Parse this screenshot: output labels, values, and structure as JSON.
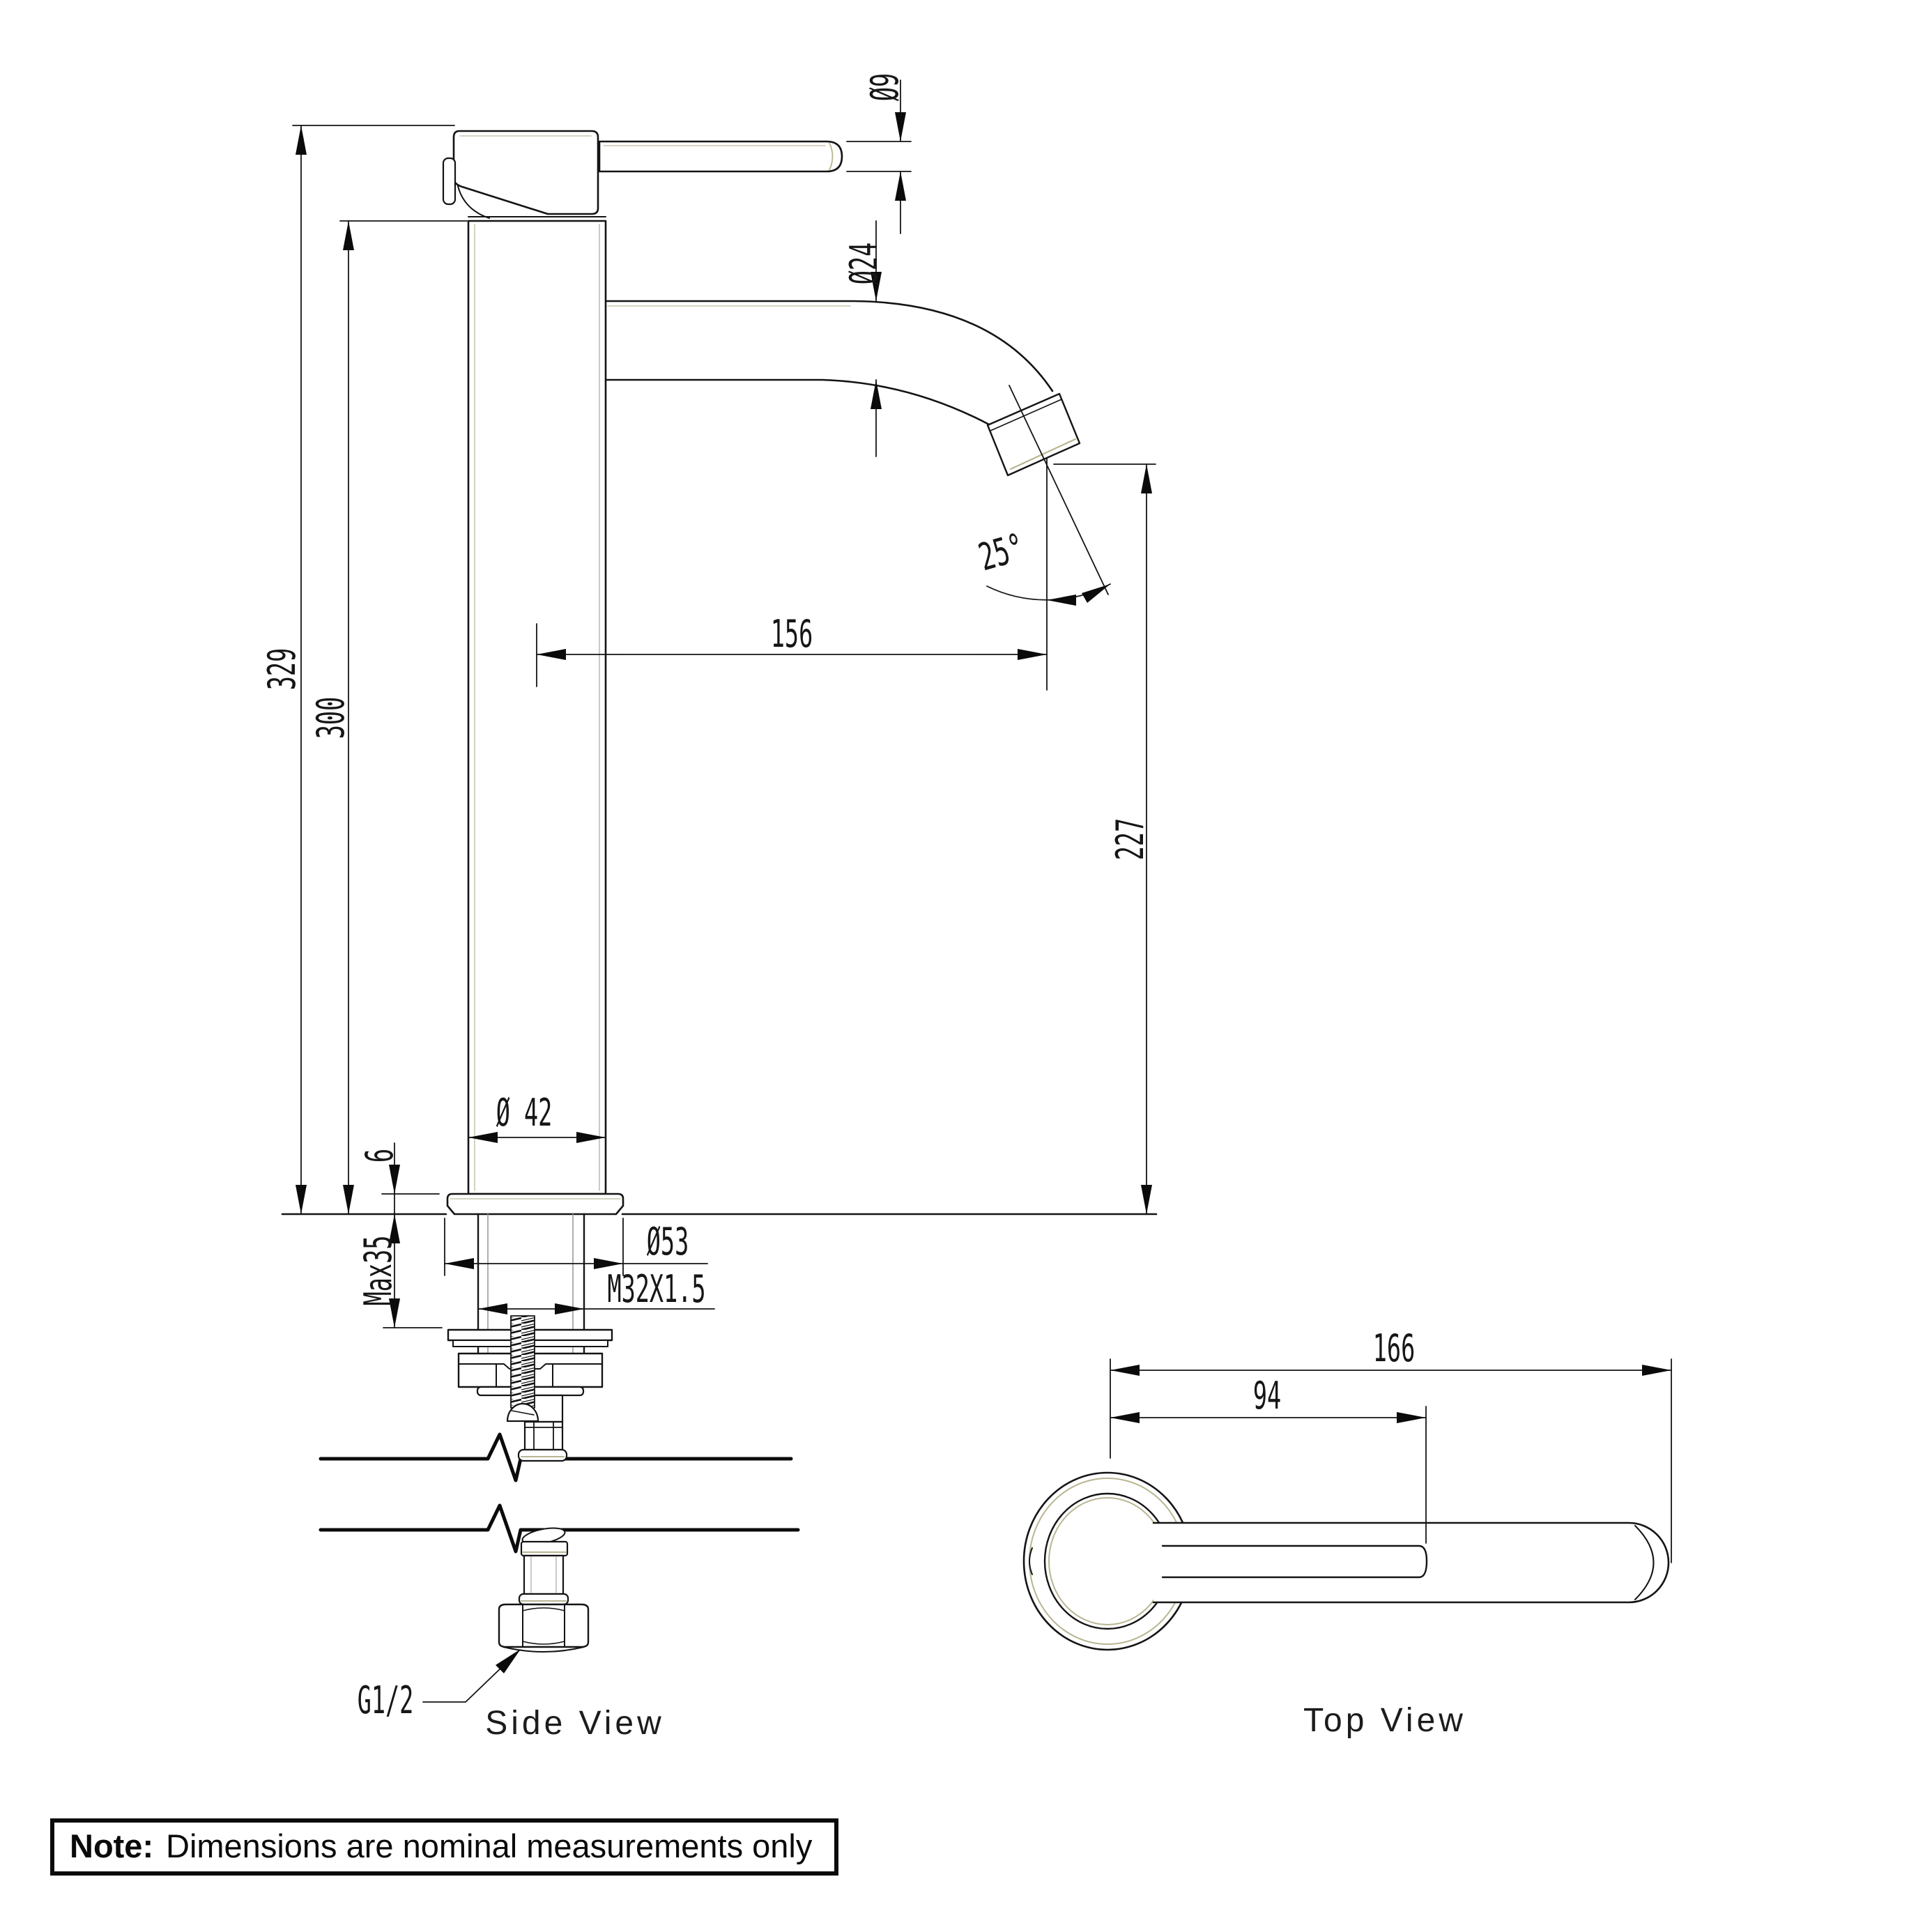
{
  "drawing": {
    "title_note": {
      "label": "Note:",
      "text": "Dimensions are nominal measurements only"
    },
    "captions": {
      "side_view": "Side View",
      "top_view": "Top View"
    },
    "side_view_dims": {
      "overall_height": "329",
      "body_height": "300",
      "spout_reach": "156",
      "spout_outlet_height": "227",
      "handle_diameter": "Ø9",
      "spout_diameter": "Ø24",
      "body_diameter": "Ø 42",
      "flange_diameter": "Ø53",
      "flange_height": "6",
      "max_counter_thickness": "Max35",
      "thread_spec": "M32X1.5",
      "outlet_angle": "25°",
      "inlet_thread": "G1/2"
    },
    "top_view_dims": {
      "overall_reach": "166",
      "spout_reach": "94"
    }
  }
}
